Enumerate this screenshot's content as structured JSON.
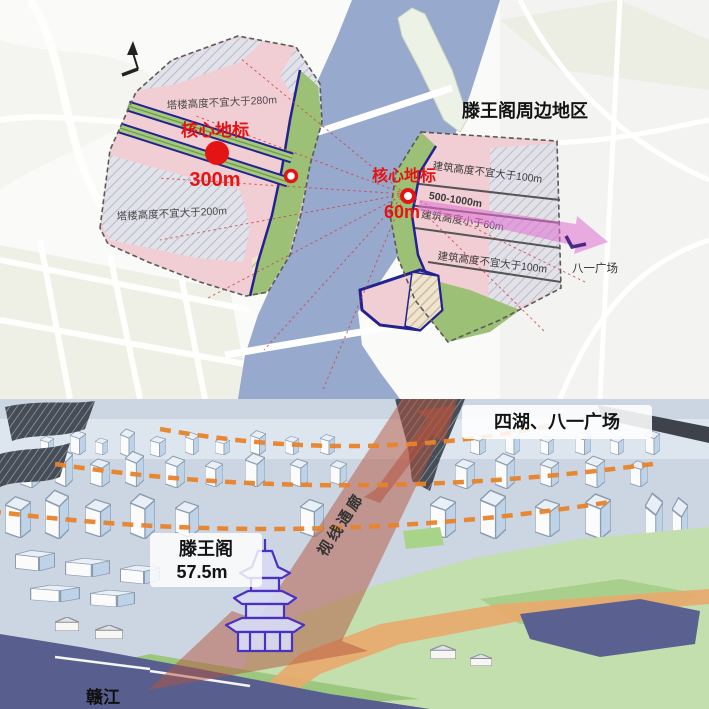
{
  "planning_map": {
    "title": "滕王阁周边地区",
    "west_zone": {
      "height_note_top": "塔楼高度不宜大于280m",
      "height_note_bottom": "塔楼高度不宜大于200m",
      "core_landmark": {
        "label": "核心地标",
        "height": "300m"
      }
    },
    "east_zone": {
      "core_landmark": {
        "label": "核心地标",
        "height": "60m"
      },
      "bands": [
        "建筑高度不宜大于100m",
        "500-1000m",
        "建筑高度小于60m",
        "建筑高度不宜大于100m"
      ],
      "axis_target": "八一广场"
    },
    "colors": {
      "zone_pink": "#f1cdd4",
      "greenway_green": "#9cc176",
      "river_blue": "#97a9cc",
      "boundary_navy": "#23238f",
      "landmark_red": "#e41414",
      "sightline_red": "#d04040",
      "axis_arrow_magenta": "#e06ed2"
    }
  },
  "perspective_view": {
    "destination_label": "四湖、八一广场",
    "pavilion": {
      "name": "滕王阁",
      "height": "57.5m"
    },
    "corridor_label": "视线通廊",
    "river_label": "赣江",
    "colors": {
      "corridor_red": "#b4543e",
      "view_arc_orange": "#e8832b",
      "pavilion_purple": "#4a31c2",
      "river_dark": "#585f8e",
      "promenade_orange": "#e9a96b",
      "park_green": "#c4dfae",
      "sky_blue": "#ccd6e2"
    }
  }
}
